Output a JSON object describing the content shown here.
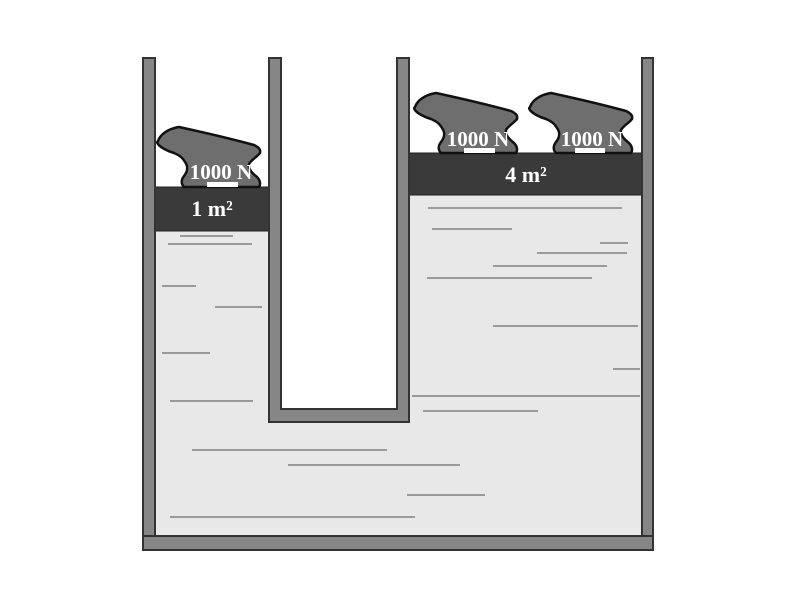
{
  "diagram": {
    "left_column": {
      "piston_label": "1 m²",
      "weights": [
        {
          "label": "1000 N"
        }
      ]
    },
    "right_column": {
      "piston_label": "4 m²",
      "weights": [
        {
          "label": "1000 N"
        },
        {
          "label": "1000 N"
        }
      ]
    },
    "colors": {
      "background": "#ffffff",
      "wall": "#868686",
      "wall_outline": "#333333",
      "piston": "#3a3a3a",
      "anvil": "#6e6e6e",
      "anvil_outline": "#111111",
      "liquid": "#e8e8e8",
      "liquid_streak": "#9a9a9a",
      "label_text": "#ffffff"
    }
  }
}
